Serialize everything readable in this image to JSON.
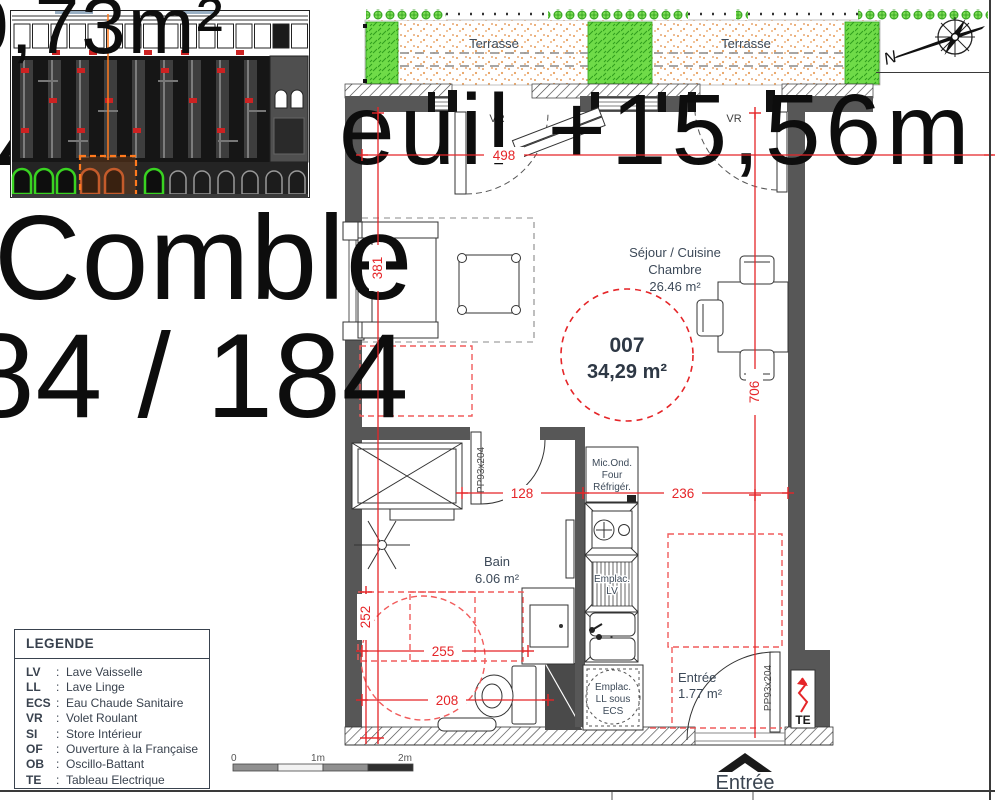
{
  "overlay": {
    "area_top": "0,73m²",
    "digit": "4",
    "seuil": "seuil +15,56m",
    "comble": "Comble",
    "fraction": "184 / 184"
  },
  "plan": {
    "terrace_left": "Terrasse",
    "terrace_right": "Terrasse",
    "vr1": "VR",
    "vr2": "VR",
    "room_main": {
      "line1": "Séjour / Cuisine",
      "line2": "Chambre",
      "area": "26.46 m²"
    },
    "unit": {
      "number": "007",
      "area": "34,29 m²"
    },
    "bath": {
      "name": "Bain",
      "area": "6.06 m²"
    },
    "kitchen_stack": [
      "Mic.Ond.",
      "Four",
      "Réfrigér."
    ],
    "lv_label": [
      "Emplac.",
      "LV"
    ],
    "ll_label": [
      "Emplac.",
      "LL sous",
      "ECS"
    ],
    "entry": {
      "name": "Entrée",
      "area": "1.77 m²"
    },
    "entry_arrow_label": "Entrée",
    "te_label": "TE",
    "door_tag_bath": "PP93x204",
    "door_tag_entry": "PP93x204",
    "dims": {
      "d498": "498",
      "d381": "381",
      "d706": "706",
      "d128": "128",
      "d236": "236",
      "d252": "252",
      "d255": "255",
      "d208": "208"
    }
  },
  "legend": {
    "title": "LEGENDE",
    "separator": ":",
    "items": [
      {
        "abbr": "LV",
        "label": "Lave Vaisselle"
      },
      {
        "abbr": "LL",
        "label": "Lave Linge"
      },
      {
        "abbr": "ECS",
        "label": "Eau Chaude Sanitaire"
      },
      {
        "abbr": "VR",
        "label": "Volet Roulant"
      },
      {
        "abbr": "SI",
        "label": "Store Intérieur"
      },
      {
        "abbr": "OF",
        "label": "Ouverture à la Française"
      },
      {
        "abbr": "OB",
        "label": "Oscillo-Battant"
      },
      {
        "abbr": "TE",
        "label": "Tableau Electrique"
      }
    ]
  },
  "scalebar": {
    "t0": "0",
    "t1": "1m",
    "t2": "2m"
  },
  "compass": {
    "label": "N"
  },
  "colors": {
    "dim_red": "#e52528",
    "zone_red": "#f15b5b",
    "wall_gray": "#575757",
    "label_slate": "#3d4a59",
    "plant_green": "#57cc33",
    "terrace_dot": "#e89a55",
    "highlight_orange": "#ff7a1e"
  }
}
